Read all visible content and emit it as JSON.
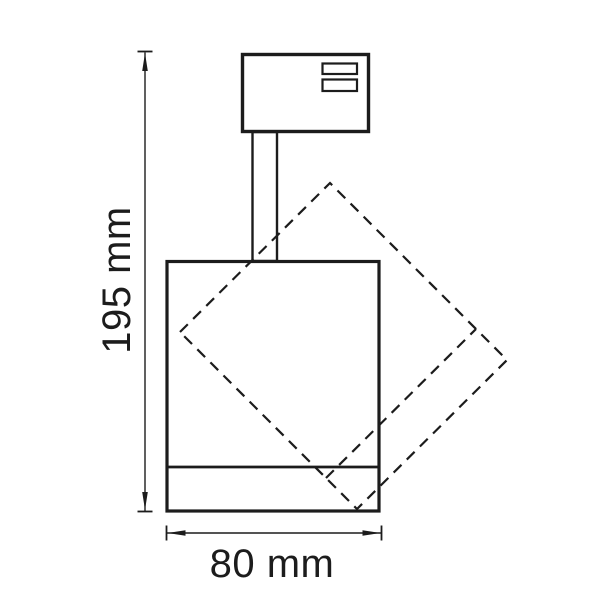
{
  "colors": {
    "line": "#1c1c1c",
    "background": "#ffffff"
  },
  "drawing": {
    "type": "technical-dimension-drawing",
    "dimensions": {
      "height": {
        "label": "195 mm",
        "value": 195,
        "unit": "mm"
      },
      "width": {
        "label": "80 mm",
        "value": 80,
        "unit": "mm"
      }
    }
  }
}
